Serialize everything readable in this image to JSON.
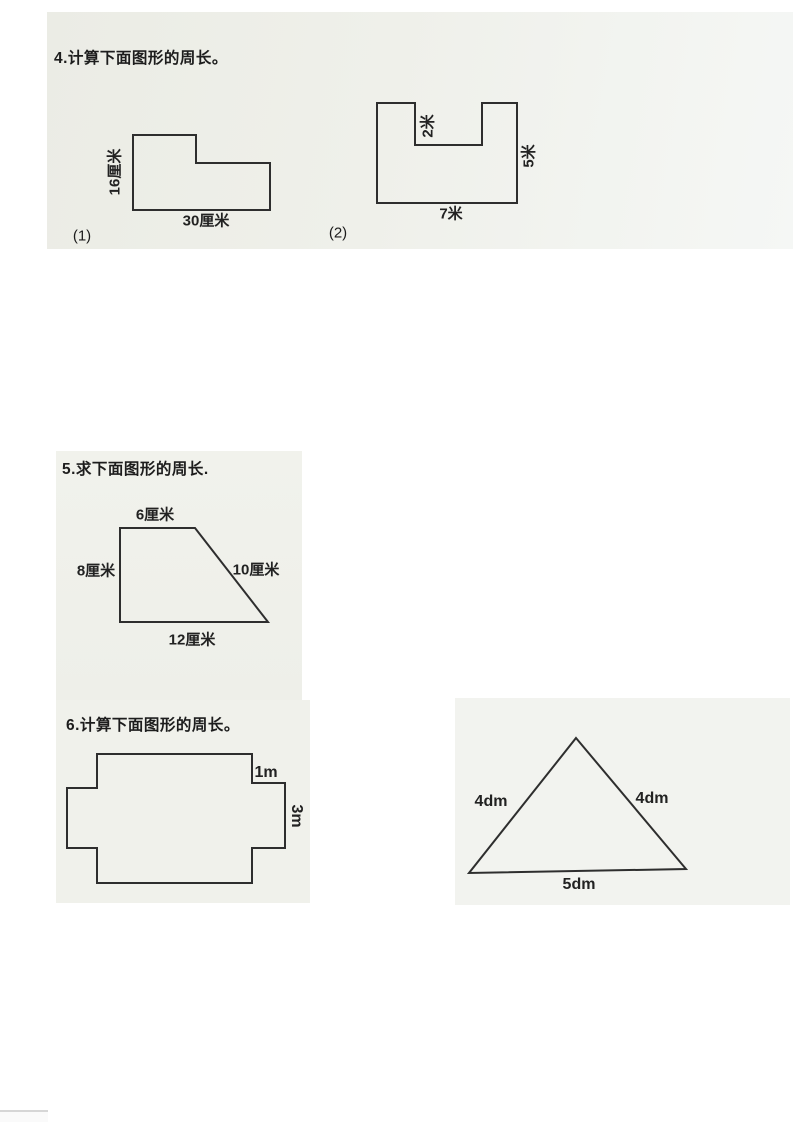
{
  "document": {
    "section4": {
      "heading": "4.计算下面图形的周长。",
      "figure1": {
        "caption": "(1)",
        "left_side": "16厘米",
        "bottom_side": "30厘米"
      },
      "figure2": {
        "caption": "(2)",
        "notch_depth": "2米",
        "right_side": "5米",
        "bottom_side": "7米"
      }
    },
    "section5": {
      "heading": "5.求下面图形的周长.",
      "trapezoid": {
        "top_side": "6厘米",
        "left_side": "8厘米",
        "slant_side": "10厘米",
        "bottom_side": "12厘米"
      }
    },
    "section6": {
      "heading": "6.计算下面图形的周长。",
      "cross": {
        "step_side": "1m",
        "right_side": "3m"
      },
      "triangle": {
        "left_side": "4dm",
        "right_side": "4dm",
        "bottom_side": "5dm"
      }
    }
  }
}
